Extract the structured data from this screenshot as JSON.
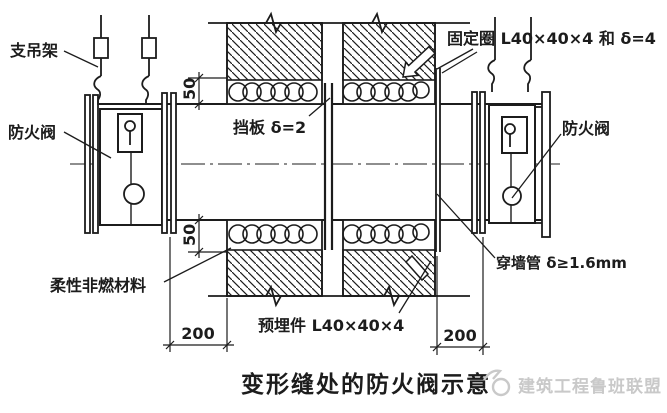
{
  "labels": {
    "hanger": "支吊架",
    "fire_damper_left": "防火阀",
    "fire_damper_right": "防火阀",
    "baffle": "挡板 δ=2",
    "fixing_ring": "固定圈 L40×40×4 和 δ=4",
    "wall_pipe": "穿墙管 δ≥1.6mm",
    "flexible_material": "柔性非燃材料",
    "embedded_part": "预埋件 L40×40×4"
  },
  "dimensions": {
    "left_offset": "200",
    "right_offset": "200",
    "top_fill_thickness": "50",
    "bottom_fill_thickness": "50"
  },
  "title": "变形缝处的防火阀示意",
  "watermark": "建筑工程鲁班联盟",
  "colors": {
    "line": "#1c1c1c",
    "watermark": "#c9c9c9",
    "background": "#ffffff"
  }
}
